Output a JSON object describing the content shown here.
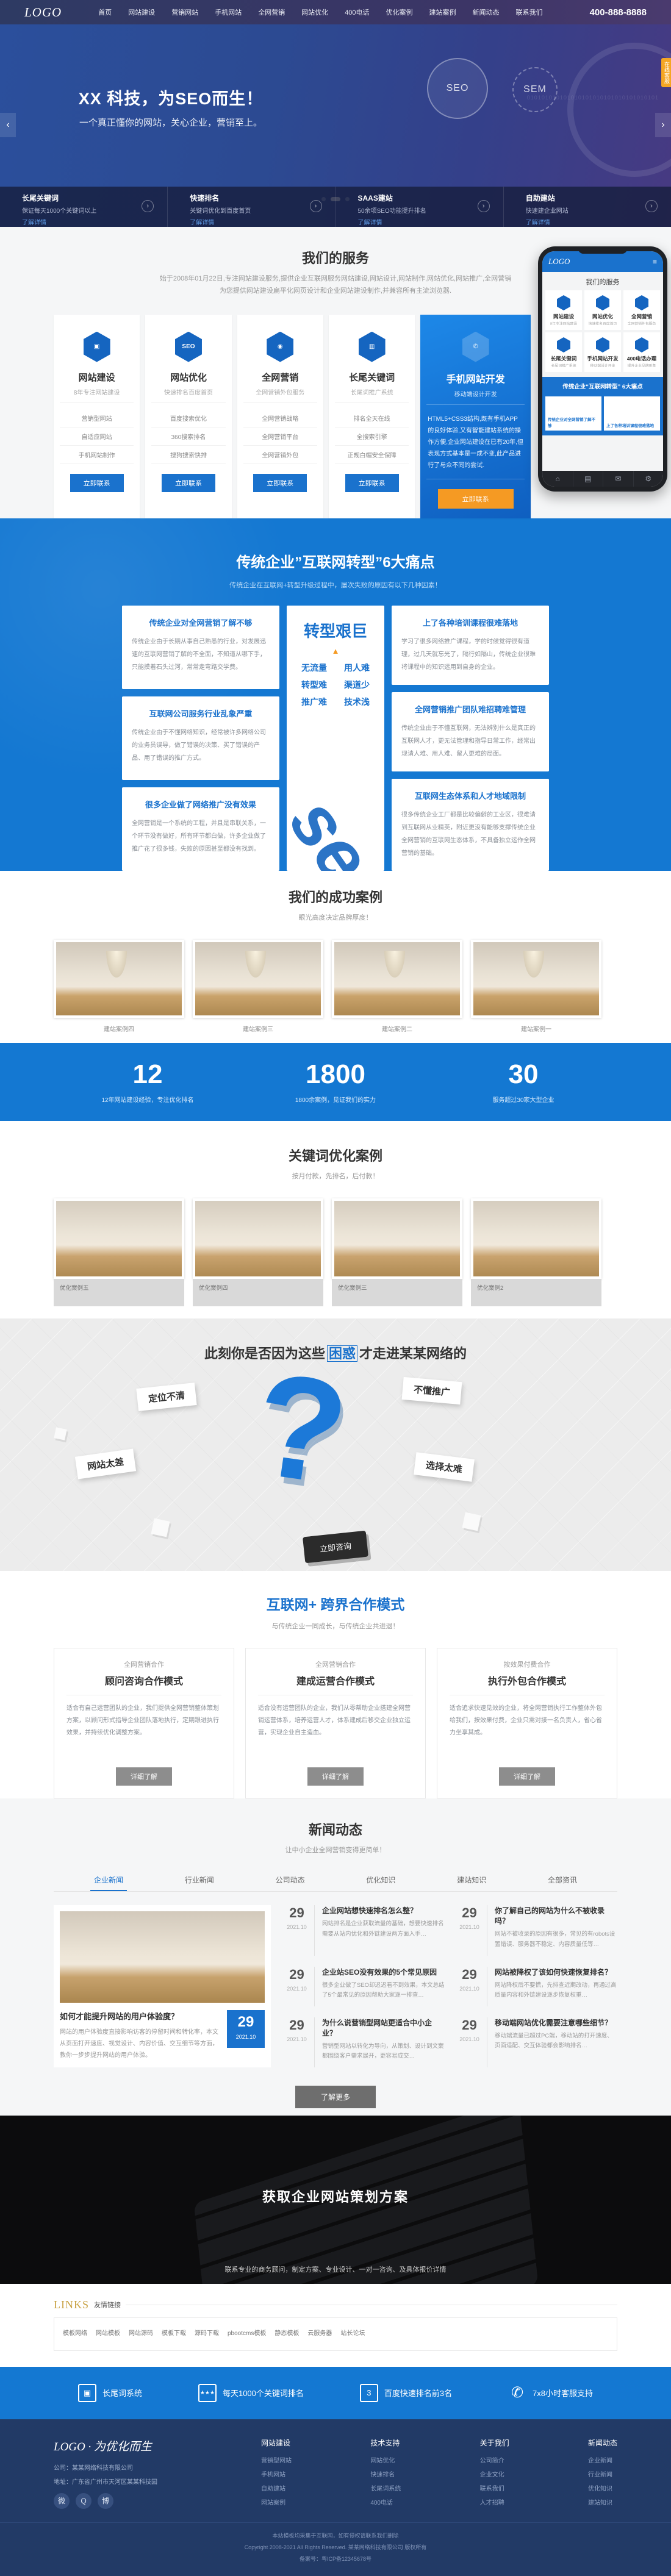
{
  "header": {
    "logo": "LOGO",
    "phone": "400-888-8888",
    "nav": [
      {
        "label": "首页"
      },
      {
        "label": "网站建设"
      },
      {
        "label": "营销网站"
      },
      {
        "label": "手机网站"
      },
      {
        "label": "全网营销"
      },
      {
        "label": "网站优化"
      },
      {
        "label": "400电话"
      },
      {
        "label": "优化案例"
      },
      {
        "label": "建站案例"
      },
      {
        "label": "新闻动态"
      },
      {
        "label": "联系我们"
      }
    ]
  },
  "hero": {
    "title": "XX 科技，为SEO而生！",
    "subtitle": "一个真正懂你的网站，关心企业，营销至上。",
    "binary": "010101010101010101010101010101010101",
    "seo": "SEO",
    "sem": "SEM",
    "side_tab": "在线客服",
    "prev": "‹",
    "next": "›"
  },
  "strip": {
    "cols": [
      {
        "title": "长尾关键词",
        "desc": "保证每天1000个关键词以上",
        "more": "了解详情",
        "icon": "›"
      },
      {
        "title": "快速排名",
        "desc": "关键词优化到百度首页",
        "more": "了解详情",
        "icon": "›"
      },
      {
        "title": "SAAS建站",
        "desc": "50余项SEO功能提升排名",
        "more": "了解详情",
        "icon": "›"
      },
      {
        "title": "自助建站",
        "desc": "快速建企业网站",
        "more": "了解详情",
        "icon": "›"
      }
    ]
  },
  "services": {
    "title": "我们的服务",
    "desc1": "始于2008年01月22日,专注网站建设服务,提供企业互联网服务网站建设,网站设计,网站制作,网站优化,网站推广,全网营销",
    "desc2": "为您提供网站建设扁平化网页设计和企业网站建设制作,并兼容所有主流浏览器.",
    "cards": [
      {
        "icon": "▣",
        "title": "网站建设",
        "sub": "8年专注网站建设",
        "items": [
          "营销型网站",
          "自适应网站",
          "手机网站制作"
        ],
        "btn": "立即联系"
      },
      {
        "icon": "SEO",
        "title": "网站优化",
        "sub": "快速排名百度首页",
        "items": [
          "百度搜索优化",
          "360搜索排名",
          "搜狗搜索快排"
        ],
        "btn": "立即联系"
      },
      {
        "icon": "◉",
        "title": "全网营销",
        "sub": "全网营销外包服务",
        "items": [
          "全网营销战略",
          "全网营销平台",
          "全网营销外包"
        ],
        "btn": "立即联系"
      },
      {
        "icon": "▥",
        "title": "长尾关键词",
        "sub": "长尾词推广系统",
        "items": [
          "排名全天在线",
          "全搜索引擎",
          "正规白帽安全保障"
        ],
        "btn": "立即联系"
      }
    ],
    "highlight": {
      "icon": "✆",
      "title": "手机网站开发",
      "sub": "移动端设计开发",
      "desc": "HTML5+CSS3结构,既有手机APP的良好体验,又有智能建站系统的操作方便,企业网站建设在已有20年,但表现方式基本是一成不变,此产品进行了与众不同的尝试.",
      "btn": "立即联系"
    }
  },
  "phone_mock": {
    "logo": "LOGO",
    "burger": "≡",
    "title": "我们的服务",
    "tiles": [
      {
        "name": "网站建设",
        "sub": "8年专注网站建设"
      },
      {
        "name": "网站优化",
        "sub": "快速排名百度首页"
      },
      {
        "name": "全网营销",
        "sub": "全网营销外包服务"
      },
      {
        "name": "长尾关键词",
        "sub": "长尾词推广系统"
      },
      {
        "name": "手机网站开发",
        "sub": "移动端设计开发"
      },
      {
        "name": "400电话办理",
        "sub": "提升企业品牌形象"
      }
    ],
    "banner": "传统企业“互联网转型” 6大痛点",
    "box1": "传统企业对全网营销了解不够",
    "box2": "上了各种培训课程很难落地",
    "nav_icons": [
      "⌂",
      "▤",
      "✉",
      "⚙"
    ]
  },
  "pains": {
    "title": "传统企业”互联网转型”6大痛点",
    "subtitle": "传统企业在互联网+转型升级过程中，屡次失败的原因有以下几种因素！",
    "left": [
      {
        "t": "传统企业对全网营销了解不够",
        "p": "传统企业由于长期从事自己熟悉的行业，对发展迅速的互联网营销了解的不全面，不知道从哪下手，只能摸着石头过河，常常走弯路交学费。"
      },
      {
        "t": "互联网公司服务行业乱象严重",
        "p": "传统企业由于不懂网络知识，经常被许多网络公司的业务员误导，做了错误的决策、买了错误的产品、用了错误的推广方式。"
      },
      {
        "t": "很多企业做了网络推广没有效果",
        "p": "全网营销是一个系统的工程，并且是串联关系，一个环节没有做好，所有环节都白做，许多企业做了推广花了很多钱，失败的原因甚至都没有找到。"
      }
    ],
    "center": {
      "big": "转型艰巨",
      "tri": "▲",
      "rows": [
        [
          "无流量",
          "用人难"
        ],
        [
          "转型难",
          "渠道少"
        ],
        [
          "推广难",
          "技术浅"
        ]
      ],
      "seo": "seo"
    },
    "right": [
      {
        "t": "上了各种培训课程很难落地",
        "p": "学习了很多网络推广课程，学的时候觉得很有道理，过几天就忘光了，隔行如隔山，传统企业很难将课程中的知识运用到自身的企业。"
      },
      {
        "t": "全网营销推广团队难招聘难管理",
        "p": "传统企业由于不懂互联网，无法辨别什么是真正的互联网人才，更无法管理和指导日常工作，经常出现请人难、用人难、留人更难的局面。"
      },
      {
        "t": "互联网生态体系和人才地域限制",
        "p": "很多传统企业工厂都是比较偏僻的工业区，很难请到互联网从业精英，附近更没有能够支撑传统企业全网营销的互联网生态体系，不具备独立运作全网营销的基础。"
      }
    ]
  },
  "cases": {
    "title": "我们的成功案例",
    "subtitle": "眼光高度决定品牌厚度！",
    "items": [
      {
        "caption": "建站案例四"
      },
      {
        "caption": "建站案例三"
      },
      {
        "caption": "建站案例二"
      },
      {
        "caption": "建站案例一"
      }
    ]
  },
  "stats": [
    {
      "num": "12",
      "desc": "12年网站建设经验，专注优化排名"
    },
    {
      "num": "1800",
      "desc": "1800余案例，见证我们的实力"
    },
    {
      "num": "30",
      "desc": "服务超过30家大型企业"
    }
  ],
  "keyword_cases": {
    "title": "关键词优化案例",
    "subtitle": "按月付款，先排名，后付款！",
    "items": [
      {
        "caption": "优化案例五"
      },
      {
        "caption": "优化案例四"
      },
      {
        "caption": "优化案例三"
      },
      {
        "caption": "优化案例2"
      }
    ]
  },
  "confusion": {
    "title_pre": "此刻你是否因为这些",
    "title_hl": "困惑",
    "title_post": "才走进某某网络的",
    "qmark": "?",
    "labels": [
      "定位不清",
      "不懂推广",
      "网站太差",
      "选择太难"
    ],
    "btn": "立即咨询"
  },
  "coop": {
    "title": "互联网+ 跨界合作模式",
    "subtitle": "与传统企业一同成长，与传统企业共进退！",
    "cards": [
      {
        "small": "全网营销合作",
        "big": "顾问咨询合作模式",
        "p": "适合有自己运营团队的企业，我们提供全网营销整体策划方案，以顾问形式指导企业团队落地执行，定期跟进执行效果，并持续优化调整方案。",
        "btn": "详细了解"
      },
      {
        "small": "全网营销合作",
        "big": "建成运营合作模式",
        "p": "适合没有运营团队的企业，我们从零帮助企业搭建全网营销运营体系，培养运营人才，体系建成后移交企业独立运营，实现企业自主造血。",
        "btn": "详细了解"
      },
      {
        "small": "按效果付费合作",
        "big": "执行外包合作模式",
        "p": "适合追求快速见效的企业，将全网营销执行工作整体外包给我们，按效果付费，企业只需对接一名负责人，省心省力坐享其成。",
        "btn": "详细了解"
      }
    ]
  },
  "news": {
    "title": "新闻动态",
    "subtitle": "让中小企业全网营销变得更简单！",
    "tabs": [
      "企业新闻",
      "行业新闻",
      "公司动态",
      "优化知识",
      "建站知识",
      "全部资讯"
    ],
    "featured": {
      "title": "如何才能提升网站的用户体验度？",
      "excerpt": "网站的用户体验度直接影响访客的停留时间和转化率，本文从页面打开速度、视觉设计、内容价值、交互细节等方面，教你一步步提升网站的用户体验。",
      "day": "29",
      "ym": "2021.10"
    },
    "items": [
      {
        "day": "29",
        "ym": "2021.10",
        "title": "企业网站想快速排名怎么整？",
        "excerpt": "网站排名是企业获取流量的基础，想要快速排名需要从站内优化和外链建设两方面入手…"
      },
      {
        "day": "29",
        "ym": "2021.10",
        "title": "你了解自己的网站为什么不被收录吗？",
        "excerpt": "网站不被收录的原因有很多，常见的有robots设置错误、服务器不稳定、内容质量低等…"
      },
      {
        "day": "29",
        "ym": "2021.10",
        "title": "企业站SEO没有效果的5个常见原因",
        "excerpt": "很多企业做了SEO却迟迟看不到效果，本文总结了5个最常见的原因帮助大家逐一排查…"
      },
      {
        "day": "29",
        "ym": "2021.10",
        "title": "网站被降权了该如何快速恢复排名？",
        "excerpt": "网站降权后不要慌，先排查近期改动，再通过高质量内容和外链建设逐步恢复权重…"
      },
      {
        "day": "29",
        "ym": "2021.10",
        "title": "为什么说营销型网站更适合中小企业？",
        "excerpt": "营销型网站以转化为导向，从策划、设计到文案都围绕客户需求展开，更容易成交…"
      },
      {
        "day": "29",
        "ym": "2021.10",
        "title": "移动端网站优化需要注意哪些细节？",
        "excerpt": "移动端流量已超过PC端，移动站的打开速度、页面适配、交互体验都会影响排名…"
      }
    ],
    "more": "了解更多"
  },
  "cta": {
    "title": "获取企业网站策划方案",
    "subtitle": "联系专业的商务顾问，制定方案、专业设计、一对一咨询、及具体报价详情"
  },
  "links": {
    "en": "LINKS",
    "cn": "友情链接",
    "items": [
      "模板网络",
      "网站模板",
      "网站源码",
      "模板下载",
      "源码下载",
      "pbootcms模板",
      "静态模板",
      "云服务器",
      "站长论坛"
    ]
  },
  "fbar": [
    {
      "icon": "▣",
      "text": "长尾词系统"
    },
    {
      "icon": "★★★",
      "text": "每天1000个关键词排名"
    },
    {
      "icon": "3",
      "text": "百度快速排名前3名"
    },
    {
      "icon": "✆",
      "text": "7x8小时客服支持"
    }
  ],
  "footer": {
    "logo": "LOGO · 为优化而生",
    "company": "公司：某某网络科技有限公司",
    "addr": "地址：广东省广州市天河区某某科技园",
    "socials": [
      "微",
      "Q",
      "博"
    ],
    "cols": [
      {
        "h": "网站建设",
        "links": [
          "营销型网站",
          "手机网站",
          "自助建站",
          "网站案例"
        ]
      },
      {
        "h": "技术支持",
        "links": [
          "网站优化",
          "快速排名",
          "长尾词系统",
          "400电话"
        ]
      },
      {
        "h": "关于我们",
        "links": [
          "公司简介",
          "企业文化",
          "联系我们",
          "人才招聘"
        ]
      },
      {
        "h": "新闻动态",
        "links": [
          "企业新闻",
          "行业新闻",
          "优化知识",
          "建站知识"
        ]
      }
    ],
    "copy1": "本站模板均采集于互联网，如有侵权请联系我们删除",
    "copy2": "Copyright 2008-2021 All Rights Reserved. 某某网络科技有限公司 版权所有",
    "copy3": "备案号：粤ICP备12345678号"
  }
}
